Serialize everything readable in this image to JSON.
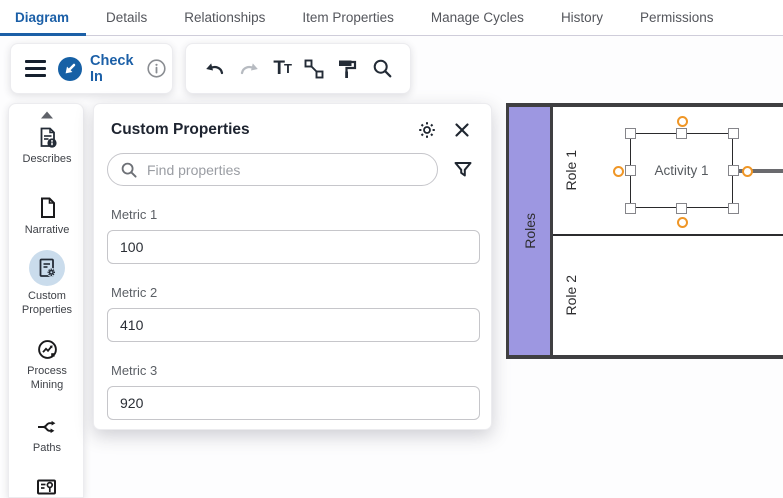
{
  "colors": {
    "accent_blue": "#1b5fa7",
    "lane_purple": "#9d97e1",
    "anchor_orange": "#ef9626",
    "pool_border": "#3f3f41",
    "selected_item_bg": "#cadcec"
  },
  "tabs": {
    "active": "Diagram",
    "items": [
      {
        "label": "Diagram"
      },
      {
        "label": "Details"
      },
      {
        "label": "Relationships"
      },
      {
        "label": "Item Properties"
      },
      {
        "label": "Manage Cycles"
      },
      {
        "label": "History"
      },
      {
        "label": "Permissions"
      }
    ]
  },
  "toolbar": {
    "check_in_label": "Check In",
    "icons": [
      "menu-icon",
      "check-in-icon",
      "info-icon",
      "undo-icon",
      "redo-icon",
      "text-format-icon",
      "connector-icon",
      "format-painter-icon",
      "search-icon"
    ]
  },
  "sidebar": {
    "scroll_up_icon": "chevron-up",
    "items": [
      {
        "label": "Describes",
        "icon": "document-info-icon",
        "selected": false
      },
      {
        "label": "Narrative",
        "icon": "page-icon",
        "selected": false
      },
      {
        "label": "Custom Properties",
        "icon": "document-gear-icon",
        "selected": true
      },
      {
        "label": "Process Mining",
        "icon": "chart-circle-icon",
        "selected": false
      },
      {
        "label": "Paths",
        "icon": "branch-icon",
        "selected": false
      }
    ]
  },
  "panel": {
    "title": "Custom Properties",
    "search_placeholder": "Find properties",
    "header_icons": [
      "gear-icon",
      "close-icon"
    ],
    "filter_icon": "filter-funnel-icon",
    "fields": [
      {
        "label": "Metric 1",
        "value": "100"
      },
      {
        "label": "Metric 2",
        "value": "410"
      },
      {
        "label": "Metric 3",
        "value": "920"
      }
    ]
  },
  "diagram": {
    "pool_label": "Roles",
    "lanes": [
      {
        "label": "Role 1"
      },
      {
        "label": "Role 2"
      }
    ],
    "activity": {
      "label": "Activity 1",
      "selected": true,
      "anchors": 4,
      "handles": 8
    }
  }
}
